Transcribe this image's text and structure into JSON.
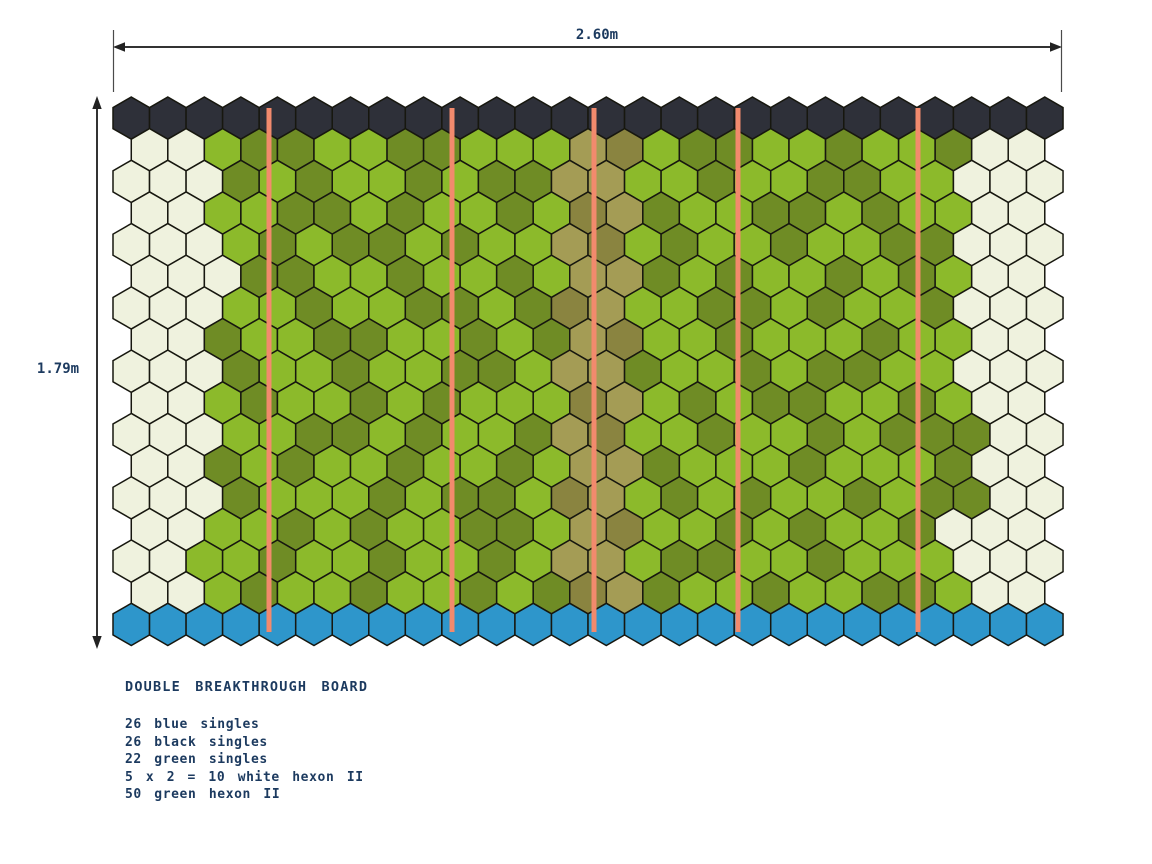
{
  "annotations": {
    "width_label": "2.60m",
    "height_label": "1.79m",
    "title": "DOUBLE BREAKTHROUGH BOARD",
    "parts": [
      "26 blue singles",
      "26 black singles",
      "22 green singles",
      "5 x 2 = 10 white hexon II",
      "50 green hexon II"
    ]
  },
  "text_color": "#1c3a5f",
  "board": {
    "origin_x": 113,
    "origin_y": 97,
    "hex_width": 36.54,
    "stroke_color": "#17170f",
    "stroke_width": 1.5,
    "colors": {
      "K": "#2e3039",
      "W": "#eff2de",
      "G": "#8cba2b",
      "D": "#6f8c25",
      "L": "#a49c55",
      "E": "#8a8440",
      "B": "#2e96cb"
    },
    "color_legend": {
      "K": "black single (top row)",
      "W": "white hexon II",
      "G": "green light",
      "D": "green dark",
      "L": "green shaded light (center band)",
      "E": "green shaded dark (center band)",
      "B": "blue single (bottom row)"
    },
    "rows": [
      "KKKKKKKKKKKKKKKKKKKKKKKKKK",
      "WWGDDGGDDGGGLEGDDGGDGGDWW",
      "WWWDGDGGDGDDLLGGDGGDDGGWWW",
      "WWGGDDGDGGDGELDGGDDGDGGWW",
      "WWWGDGDDGDGGLEGDGGDGGDDWWW",
      "WWWDDGGDGGDGLLDGDGGDGDGWW",
      "WWWGGDGGDDGDELGGDDGDGGDWWW",
      "WWDGGDDGGDGDLEGGDGGGDGGWW",
      "WWWDGGDGGDDGLLDGGDGDDGGWWW",
      "WWGDGGDGDGGGELGDGDDGGDGWW",
      "WWWGGDDGDGGDLEGGDGGDGDDDWW",
      "WWDGDGGDGGDGLLDGGGDGGGDWW",
      "WWWDGGGDGDDGELGDGDGGDGDDWW",
      "WWGGDGDGGDDGLEGGDGDGGDWWW",
      "WWGGDGGDGGDGLLGDDGGDGGGWWW",
      "WWGDGGDGGDGDELDGGDGGDDGWW",
      "BBBBBBBBBBBBBBBBBBBBBBBBBB"
    ],
    "divider_lines": {
      "color": "#f28a6d",
      "width": 5,
      "y1": 108,
      "y2": 632,
      "x_positions": [
        269,
        452,
        594,
        738,
        918
      ]
    }
  }
}
